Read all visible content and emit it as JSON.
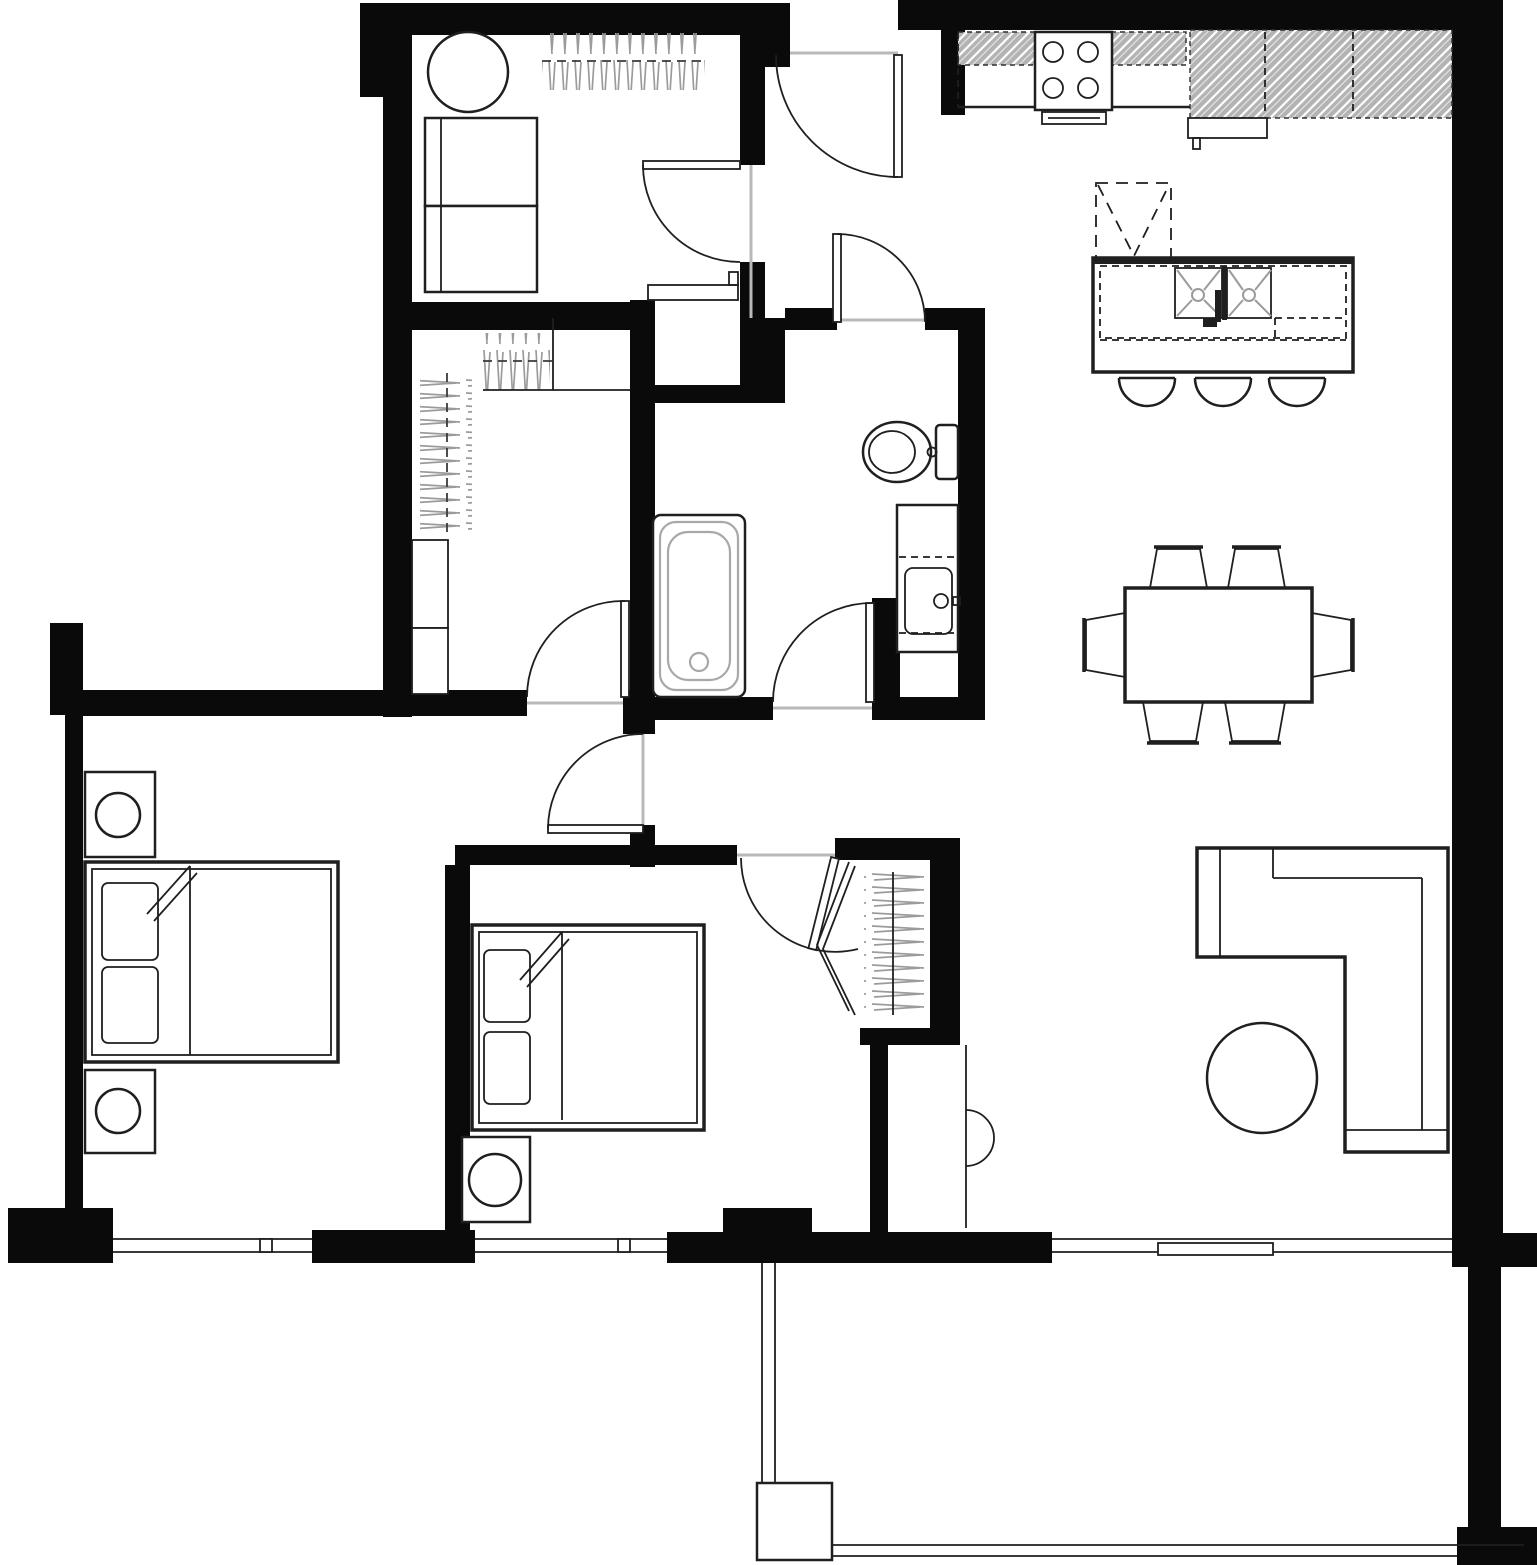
{
  "page": {
    "title": "Two-bedroom apartment floor plan",
    "kind": "architectural-floor-plan",
    "visible_text": ""
  },
  "canvas": {
    "width": 1537,
    "height": 1565,
    "viewbox": "0 0 1537 1565"
  },
  "colors": {
    "background": "#ffffff",
    "wall": "#0a0a0a",
    "line": "#1f1f1f",
    "opening": "#b9b9b9",
    "clothes": "#9b9b9b",
    "cabinet_hatch": "#b3b3b3",
    "tub_outline": "#a8a8a8"
  },
  "areas": {
    "laundry_room": {
      "fixtures": [
        "water-heater",
        "stacked-washer-dryer",
        "hanging-rod-clothes",
        "utility-counter-sink"
      ]
    },
    "walk_in_closet": {
      "fixtures": [
        "hanging-rod-clothes-top",
        "hanging-rod-clothes-side",
        "shelves"
      ]
    },
    "bathroom": {
      "fixtures": [
        "bathtub",
        "toilet",
        "vanity-sink"
      ]
    },
    "kitchen": {
      "fixtures": [
        "upper-cabinets",
        "cooktop-oven",
        "refrigerator-tall-cabinets",
        "island-double-sink",
        "island-faucet",
        "dishwasher",
        "bar-stools"
      ],
      "bar_stool_count": 3,
      "cooktop_burners": 4
    },
    "dining_area": {
      "fixtures": [
        "dining-table",
        "dining-chairs"
      ],
      "chair_count": 6
    },
    "living_area": {
      "fixtures": [
        "sectional-sofa",
        "round-coffee-table",
        "half-round-wall-element"
      ]
    },
    "bedroom_1": {
      "fixtures": [
        "double-bed",
        "pillows",
        "nightstand-with-lamp",
        "nightstand-with-lamp"
      ]
    },
    "bedroom_2": {
      "fixtures": [
        "double-bed",
        "pillows",
        "nightstand-with-lamp",
        "bifold-closet",
        "hanging-rod-clothes"
      ]
    },
    "balcony": {
      "fixtures": [
        "support-post",
        "railing-lines"
      ]
    },
    "doors": {
      "swing_door_count": 7,
      "bifold_door_count": 1
    },
    "windows": {
      "band_count": 3
    }
  }
}
